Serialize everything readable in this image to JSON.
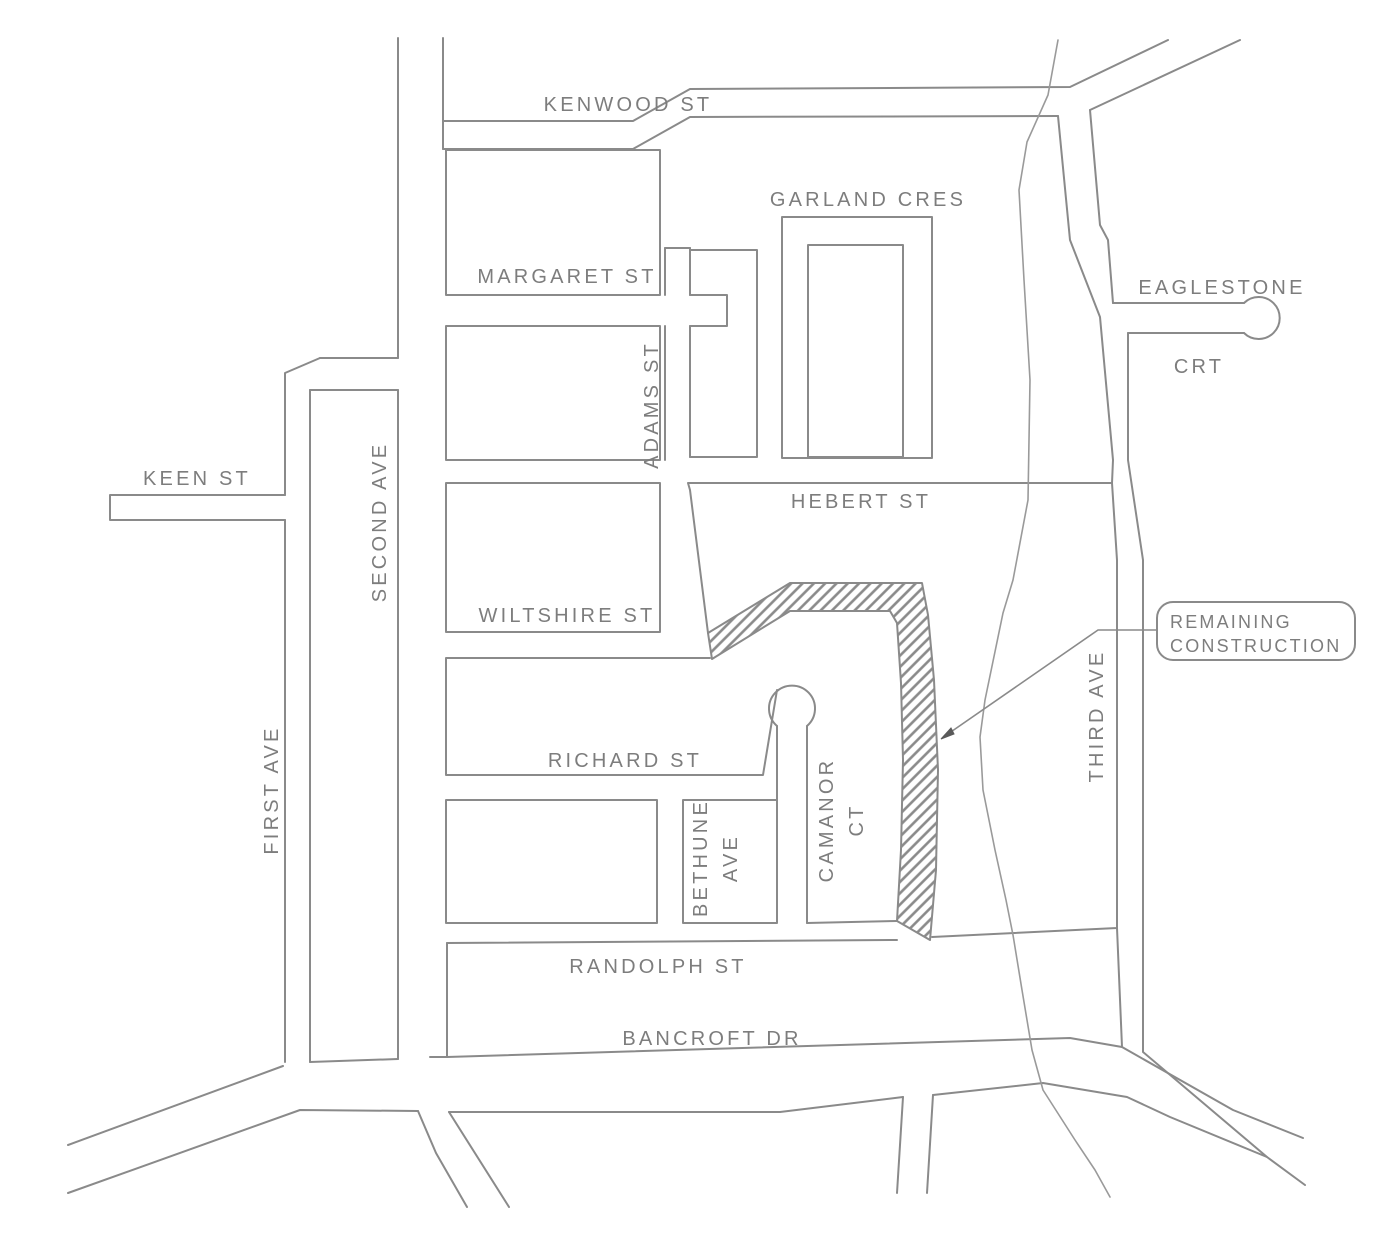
{
  "map": {
    "title": "street construction notice map",
    "colors": {
      "background": "#ffffff",
      "line": "#8a8a8a",
      "text": "#7d7d7d",
      "hatch": "#8a8a8a"
    },
    "callout": {
      "lines": [
        "REMAINING",
        "CONSTRUCTION"
      ],
      "box": {
        "x": 1157,
        "y": 602,
        "w": 198,
        "h": 58,
        "r": 16
      },
      "text_x": 1170,
      "text_y1": 622,
      "text_y2": 646,
      "leader_d": "M 1157 630 L 1098 630 L 945 736",
      "arrow_points": "941,739 954,734 951,728"
    },
    "hatch_area": {
      "name": "remaining-construction-road",
      "d": "M 708 633 L 790 583 L 922 583 L 928 615 L 934 680 L 938 770 L 936 870 L 930 940 L 897 921 L 901 850 L 903 760 L 901 683 L 897 623 L 890 611 L 790 611 L 712 659 Z"
    },
    "creek": {
      "name": "creek-line",
      "d": "M 1058 40 L 1048 95 L 1027 142 L 1019 190 L 1024 280 L 1030 380 L 1028 500 L 1013 580 L 1003 613 L 985 700 L 980 737 L 983 790 L 995 850 L 1006 900 L 1013 935 L 1022 990 L 1032 1050 L 1043 1090 L 1075 1140 L 1095 1170 L 1110 1197"
    },
    "roads": [
      {
        "name": "kenwood-st-north-edge",
        "d": "M 443 121 L 633 121 L 690 89 L 1070 87 L 1168 40"
      },
      {
        "name": "kenwood-st-south-edge",
        "d": "M 443 149 L 633 149 L 690 117 L 1058 116"
      },
      {
        "name": "northeast-road-east-edge",
        "d": "M 1240 40 L 1090 110"
      },
      {
        "name": "third-ave-west-edge-upper",
        "d": "M 1058 116 L 1070 240 L 1100 317 L 1113 460 L 1112 483"
      },
      {
        "name": "third-ave-east-edge-upper",
        "d": "M 1090 110 L 1100 225 L 1108 240 L 1113 303"
      },
      {
        "name": "eaglestone-crt-north-edge",
        "d": "M 1113 303 L 1244 303"
      },
      {
        "name": "eaglestone-crt-south-edge",
        "d": "M 1128 333 L 1244 333"
      },
      {
        "name": "eaglestone-crt-cul-de-sac",
        "d": "M 1244 303 A 21 21 0 1 1 1244 333"
      },
      {
        "name": "third-ave-east-edge-lower",
        "d": "M 1128 333 L 1128 460 L 1143 560 L 1143 1052 L 1267 1157 L 1305 1185"
      },
      {
        "name": "second-ave-west-edge",
        "d": "M 398 38 L 398 358 M 398 390 L 398 1059"
      },
      {
        "name": "second-ave-east-edge",
        "d": "M 443 38 L 443 149"
      },
      {
        "name": "first-ave-west-edge",
        "d": "M 320 358 L 285 373 L 285 495 M 285 520 L 285 1062"
      },
      {
        "name": "first-ave-east-edge",
        "d": "M 310 390 L 310 1062"
      },
      {
        "name": "connector-road-top",
        "d": "M 320 358 L 398 358"
      },
      {
        "name": "connector-road-bottom",
        "d": "M 310 390 L 398 390"
      },
      {
        "name": "keen-st-outline",
        "d": "M 285 495 L 110 495 L 110 520 L 285 520"
      },
      {
        "name": "block-margaret",
        "d": "M 446 150 L 660 150 L 660 295 L 446 295 Z"
      },
      {
        "name": "block-adams",
        "d": "M 446 326 L 660 326 L 660 460 L 446 460 Z"
      },
      {
        "name": "block-wiltshire",
        "d": "M 446 483 L 660 483 L 660 632 L 446 632 Z"
      },
      {
        "name": "adams-st-west-edge",
        "d": "M 665 248 L 665 295 M 665 326 L 665 460"
      },
      {
        "name": "adams-st-north-cap",
        "d": "M 665 248 L 690 248"
      },
      {
        "name": "adams-st-east-edge",
        "d": "M 690 248 L 690 295 M 690 326 L 690 457"
      },
      {
        "name": "margaret-st-east-stub",
        "d": "M 690 295 L 727 295 L 727 326 L 690 326"
      },
      {
        "name": "block-northeast-of-adams",
        "d": "M 690 250 L 757 250 L 757 457 L 690 457"
      },
      {
        "name": "garland-cres-outer",
        "d": "M 782 217 L 932 217 L 932 458 L 782 458 Z"
      },
      {
        "name": "garland-cres-inner-island",
        "d": "M 808 245 L 903 245 L 903 457 L 808 457 Z"
      },
      {
        "name": "block-hebert",
        "d": "M 708 633 L 690 490 L 688 483 L 1112 483 L 1117 560 L 1117 928 L 932 937"
      },
      {
        "name": "block-richard",
        "d": "M 710 658 L 446 658 L 446 775 L 763 775 L 777 690"
      },
      {
        "name": "camanor-ct-cul-de-sac",
        "d": "M 777 726 A 23 23 0 1 1 807 726"
      },
      {
        "name": "camanor-ct-west-edge",
        "d": "M 777 726 L 777 800"
      },
      {
        "name": "camanor-ct-east-edge",
        "d": "M 807 726 L 807 923"
      },
      {
        "name": "block-southwest",
        "d": "M 446 800 L 657 800 L 657 923 L 446 923 Z"
      },
      {
        "name": "block-bethune",
        "d": "M 683 800 L 777 800 L 777 923 L 683 923 Z"
      },
      {
        "name": "camanor-strip-south-edge",
        "d": "M 807 923 L 897 921"
      },
      {
        "name": "randolph-corridor-north-edge",
        "d": "M 447 943 L 897 940"
      },
      {
        "name": "randolph-corridor-west-edge",
        "d": "M 447 943 L 447 1057"
      },
      {
        "name": "randolph-corridor-south-edge",
        "d": "M 447 1057 L 1070 1038 L 1122 1047"
      },
      {
        "name": "third-ave-west-edge-lower",
        "d": "M 1117 928 L 1122 1047 L 1233 1110 L 1303 1138"
      },
      {
        "name": "bottom-road-north-edge",
        "d": "M 68 1145 L 283 1066 M 310 1062 L 398 1059 M 430 1057 L 447 1057"
      },
      {
        "name": "bottom-road-south-edge",
        "d": "M 68 1193 L 300 1110 L 418 1111 M 449 1112 L 780 1112 L 903 1097 M 933 1095 L 1043 1083 L 1127 1097 L 1170 1117 L 1267 1157"
      },
      {
        "name": "branch-road-southeast",
        "d": "M 418 1111 L 436 1153 L 467 1207 M 449 1112 L 509 1207"
      },
      {
        "name": "south-stub-road",
        "d": "M 903 1097 L 897 1193 M 933 1095 L 927 1193"
      }
    ],
    "labels": [
      {
        "id": "kenwood-st",
        "text": "KENWOOD  ST",
        "x": 628,
        "y": 105,
        "rotate": 0
      },
      {
        "id": "garland-cres",
        "text": "GARLAND CRES",
        "x": 868,
        "y": 200,
        "rotate": 0
      },
      {
        "id": "margaret-st",
        "text": "MARGARET  ST",
        "x": 567,
        "y": 277,
        "rotate": 0
      },
      {
        "id": "eaglestone",
        "text": "EAGLESTONE",
        "x": 1222,
        "y": 288,
        "rotate": 0
      },
      {
        "id": "crt",
        "text": "CRT",
        "x": 1199,
        "y": 367,
        "rotate": 0
      },
      {
        "id": "adams-st",
        "text": "ADAMS ST",
        "x": 652,
        "y": 405,
        "rotate": -90
      },
      {
        "id": "keen-st",
        "text": "KEEN   ST",
        "x": 197,
        "y": 479,
        "rotate": 0
      },
      {
        "id": "second-ave",
        "text": "SECOND AVE",
        "x": 380,
        "y": 522,
        "rotate": -90
      },
      {
        "id": "hebert-st",
        "text": "HEBERT  ST",
        "x": 861,
        "y": 502,
        "rotate": 0
      },
      {
        "id": "wiltshire-st",
        "text": "WILTSHIRE  ST",
        "x": 567,
        "y": 616,
        "rotate": 0
      },
      {
        "id": "first-ave",
        "text": "FIRST  AVE",
        "x": 272,
        "y": 790,
        "rotate": -90
      },
      {
        "id": "richard-st",
        "text": "RICHARD ST",
        "x": 625,
        "y": 761,
        "rotate": 0
      },
      {
        "id": "camanor-ct",
        "lines": [
          "CAMANOR",
          "CT"
        ],
        "x": 827,
        "y": 820,
        "rotate": -90,
        "line_gap": 30
      },
      {
        "id": "bethune-ave",
        "lines": [
          "BETHUNE",
          "AVE"
        ],
        "x": 701,
        "y": 858,
        "rotate": -90,
        "line_gap": 30
      },
      {
        "id": "third-ave",
        "text": "THIRD  AVE",
        "x": 1097,
        "y": 716,
        "rotate": -90
      },
      {
        "id": "randolph-st",
        "text": "RANDOLPH  ST",
        "x": 658,
        "y": 967,
        "rotate": 0
      },
      {
        "id": "bancroft-dr",
        "text": "BANCROFT  DR",
        "x": 712,
        "y": 1039,
        "rotate": 0
      }
    ]
  }
}
